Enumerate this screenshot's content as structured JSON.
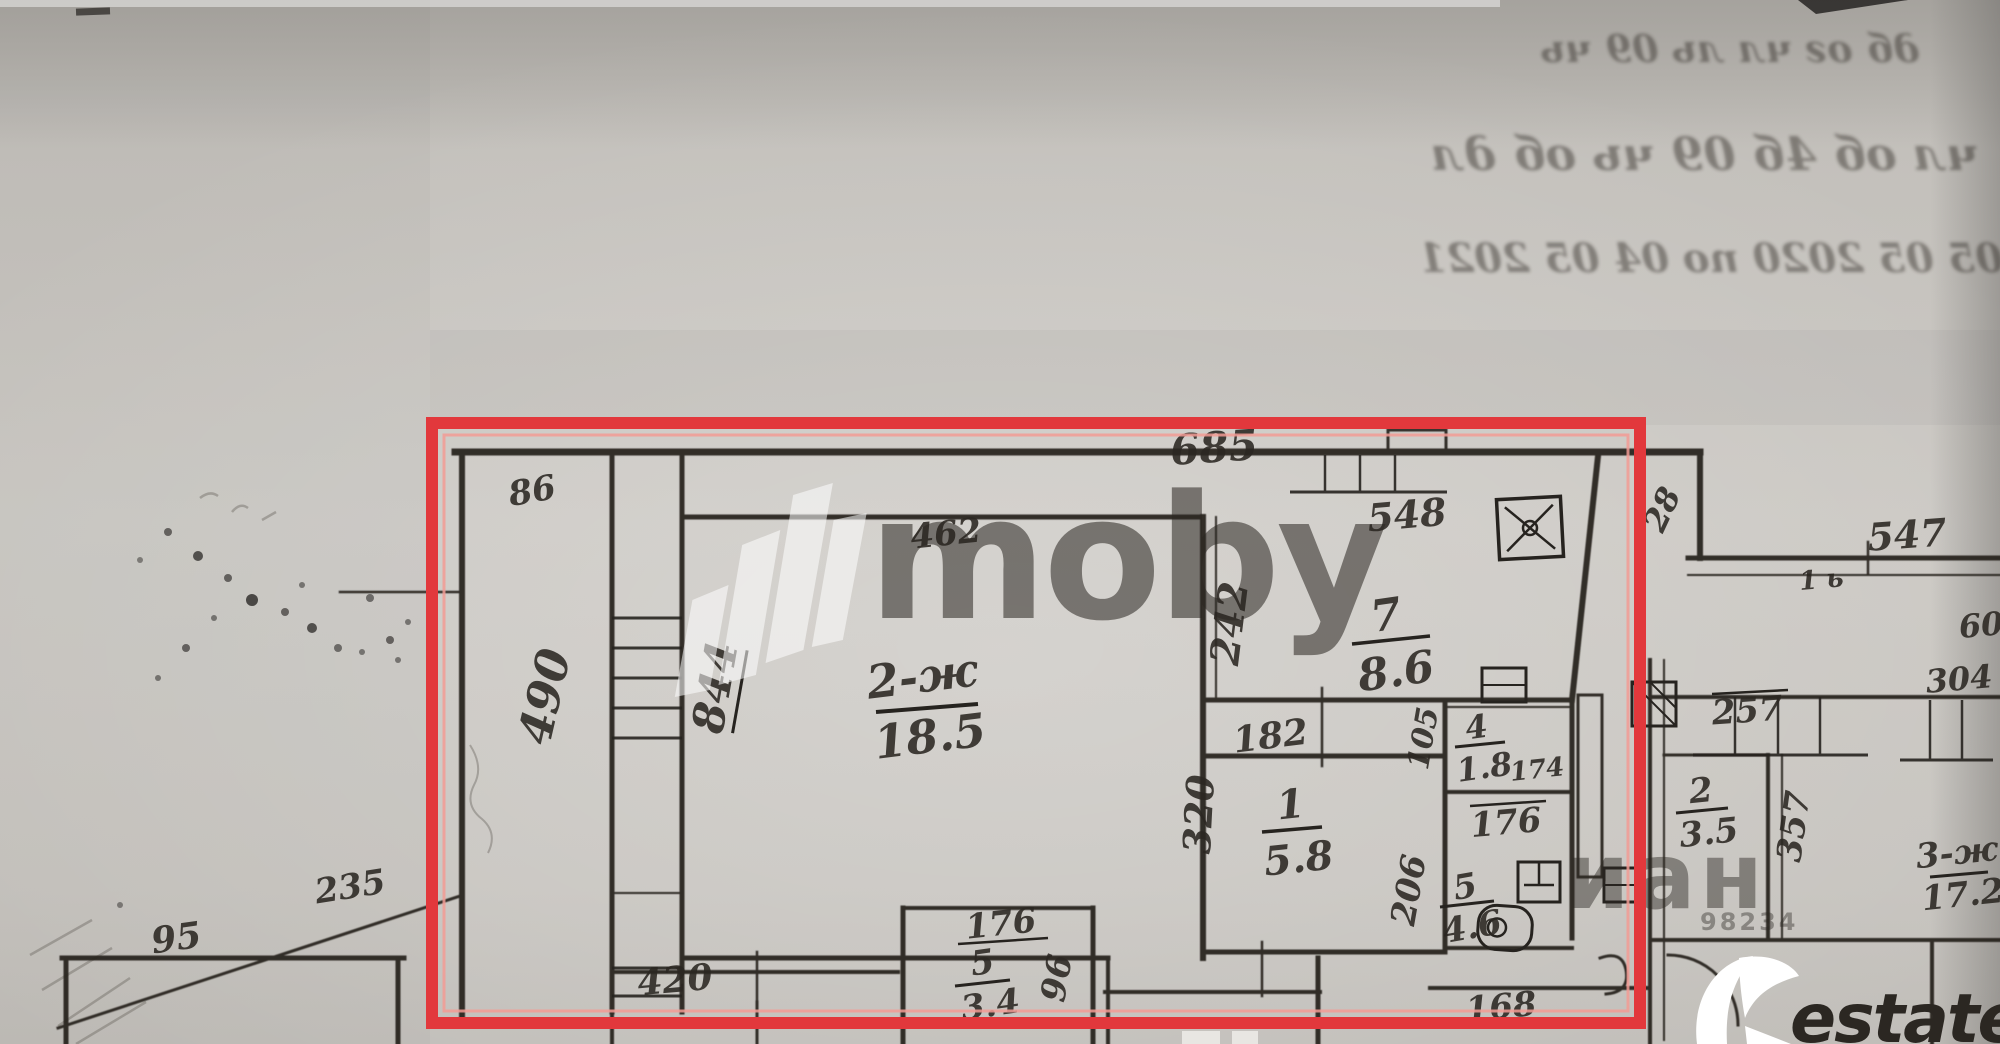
{
  "document": {
    "type": "scanned apartment floor plan (BTI technical passport fragment)",
    "highlight_color": "#e2383c",
    "paper_color": "#c7c4bf",
    "ink_color": "#2b2722"
  },
  "labels": {
    "dim_685": "685",
    "loggia_width_86": "86",
    "loggia_len_490": "490",
    "living_left_844": "844",
    "living_top_462": "462",
    "room2_num": "2-ж",
    "room2_area": "18.5",
    "kitchen_dim_548": "548",
    "kitchen_num": "7",
    "kitchen_area": "8.6",
    "kitchen_left_242": "242",
    "living_right_320": "320",
    "hall_width_182": "182",
    "closet_width_105": "105",
    "closet_num": "4",
    "closet_area": "1.8",
    "closet_len_174": "174",
    "bath_width_176": "176",
    "hall_num": "1",
    "hall_area": "5.8",
    "bath_len_206": "206",
    "bath_num": "5",
    "bath_area": "4.6",
    "out_dim_235": "235",
    "low_room_95": "95",
    "low_dim_420": "420",
    "low_dim_176": "176",
    "low_num": "5",
    "low_area": "3.4",
    "low_dim_96": "96",
    "low_dim_168": "168",
    "right_dim_28": "28",
    "right_dim_547": "547",
    "right_dim_60": "60",
    "right_dim_257": "257",
    "right2_num": "2",
    "right2_area": "3.5",
    "right_dim_357": "357",
    "right3_num": "3-ж",
    "right3_area": "17.2",
    "right_dim_304": "304",
    "pencil_mark": "1 ь"
  },
  "watermarks": {
    "moby_text": "moby",
    "cian_fragment": "иан",
    "cian_digits": "98234",
    "restate_text": "estate"
  },
  "bleed_through": {
    "note": "faint mirrored ink bleed from reverse side of the page (illegible)",
    "line1": "дб ог чл ль 09 чь",
    "line2": "чл об 4б 09 чь об дл",
    "line3": "с 05 05 2020 по 04 05 2021"
  }
}
